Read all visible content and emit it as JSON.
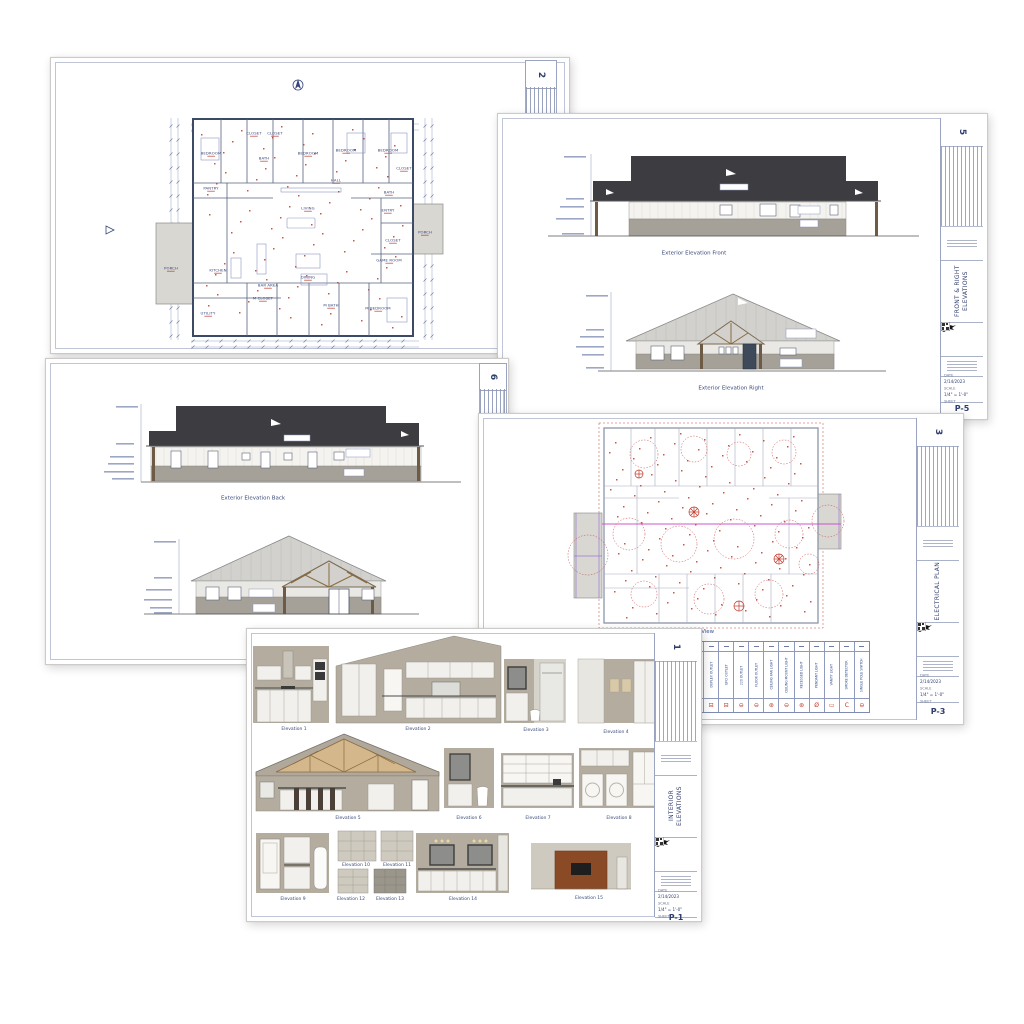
{
  "colors": {
    "line_navy": "#37477c",
    "line_red": "#c0392b",
    "roof_dark": "#3d3d41",
    "roof_light": "#d2d1cd",
    "stone_grey": "#a5a199",
    "siding_white": "#f4f3f0",
    "taupe_wall": "#b3ac9f",
    "taupe_light": "#cfcabf",
    "truss_wood": "#d4b88c",
    "accent_brown": "#8a4a26",
    "magenta": "#cc55cc"
  },
  "sheet_floor_plan": {
    "number": "2",
    "rooms": [
      {
        "label": "BEDROOM",
        "x": 160,
        "y": 96
      },
      {
        "label": "CLOSET",
        "x": 203,
        "y": 76
      },
      {
        "label": "CLOSET",
        "x": 224,
        "y": 76
      },
      {
        "label": "BATH",
        "x": 213,
        "y": 101
      },
      {
        "label": "BEDROOM",
        "x": 257,
        "y": 96
      },
      {
        "label": "BEDROOM",
        "x": 295,
        "y": 93
      },
      {
        "label": "BEDROOM",
        "x": 337,
        "y": 93
      },
      {
        "label": "CLOSET",
        "x": 353,
        "y": 111
      },
      {
        "label": "HALL",
        "x": 285,
        "y": 123
      },
      {
        "label": "PANTRY",
        "x": 160,
        "y": 131
      },
      {
        "label": "BATH",
        "x": 338,
        "y": 135
      },
      {
        "label": "ENTRY",
        "x": 337,
        "y": 153
      },
      {
        "label": "LIVING",
        "x": 257,
        "y": 151
      },
      {
        "label": "PORCH",
        "x": 374,
        "y": 175
      },
      {
        "label": "CLOSET",
        "x": 342,
        "y": 183
      },
      {
        "label": "GAME ROOM",
        "x": 338,
        "y": 203
      },
      {
        "label": "KITCHEN",
        "x": 167,
        "y": 213
      },
      {
        "label": "PORCH",
        "x": 120,
        "y": 211
      },
      {
        "label": "BAR AREA",
        "x": 217,
        "y": 228
      },
      {
        "label": "DINING",
        "x": 257,
        "y": 220
      },
      {
        "label": "UTILITY",
        "x": 157,
        "y": 256
      },
      {
        "label": "M CLOSET",
        "x": 212,
        "y": 241
      },
      {
        "label": "M BATH",
        "x": 280,
        "y": 248
      },
      {
        "label": "M BEDROOM",
        "x": 327,
        "y": 251
      }
    ]
  },
  "sheet_front_right": {
    "number": "5",
    "elevation_titles": [
      {
        "label": "Exterior Elevation Front",
        "x": 196,
        "y": 139
      },
      {
        "label": "Exterior Elevation Right",
        "x": 233,
        "y": 274
      }
    ],
    "titleblock": {
      "discipline": "FRONT & RIGHT ELEVATIONS",
      "date_label": "DATE",
      "date": "2/14/2023",
      "scale_label": "SCALE",
      "scale": "1/4\" = 1'-0\"",
      "sheet_label": "SHEET",
      "sheet_code": "P-5"
    }
  },
  "sheet_back_left": {
    "number": "6",
    "elevation_titles": [
      {
        "label": "Exterior Elevation Back",
        "x": 207,
        "y": 139
      }
    ]
  },
  "sheet_electrical": {
    "number": "3",
    "plan_view_label": "Plan View",
    "legend": [
      {
        "label": "ELECTRICAL PANEL",
        "symbol": "▮"
      },
      {
        "label": "DUPLEX OUTLET",
        "symbol": "⊟"
      },
      {
        "label": "GFCI OUTLET",
        "symbol": "⊟"
      },
      {
        "label": "220 OUTLET",
        "symbol": "⊖"
      },
      {
        "label": "FLOOR OUTLET",
        "symbol": "⊖"
      },
      {
        "label": "CEILING FAN LIGHT",
        "symbol": "⊛"
      },
      {
        "label": "CEILING MOUNT LIGHT",
        "symbol": "⊖"
      },
      {
        "label": "RECESSED LIGHT",
        "symbol": "⊛"
      },
      {
        "label": "PENDANT LIGHT",
        "symbol": "Ø"
      },
      {
        "label": "VANITY LIGHT",
        "symbol": "▭"
      },
      {
        "label": "SMOKE DETECTOR",
        "symbol": "C"
      },
      {
        "label": "SINGLE POLE SWITCH",
        "symbol": "⊖"
      }
    ],
    "titleblock": {
      "discipline": "ELECTRICAL PLAN",
      "date_label": "DATE",
      "date": "2/14/2023",
      "scale_label": "SCALE",
      "scale": "1/4\" = 1'-0\"",
      "sheet_label": "SHEET",
      "sheet_code": "P-3"
    }
  },
  "sheet_interior": {
    "number": "1",
    "elevation_labels": [
      {
        "label": "Elevation 1",
        "x": 47,
        "y": 100
      },
      {
        "label": "Elevation 2",
        "x": 171,
        "y": 100
      },
      {
        "label": "Elevation 3",
        "x": 289,
        "y": 101
      },
      {
        "label": "Elevation 4",
        "x": 369,
        "y": 103
      },
      {
        "label": "Elevation 5",
        "x": 101,
        "y": 189
      },
      {
        "label": "Elevation 6",
        "x": 222,
        "y": 189
      },
      {
        "label": "Elevation 7",
        "x": 291,
        "y": 189
      },
      {
        "label": "Elevation 8",
        "x": 372,
        "y": 189
      },
      {
        "label": "Elevation 9",
        "x": 46,
        "y": 270
      },
      {
        "label": "Elevation 10",
        "x": 109,
        "y": 236
      },
      {
        "label": "Elevation 11",
        "x": 150,
        "y": 236
      },
      {
        "label": "Elevation 12",
        "x": 104,
        "y": 270
      },
      {
        "label": "Elevation 13",
        "x": 143,
        "y": 270
      },
      {
        "label": "Elevation 14",
        "x": 216,
        "y": 270
      },
      {
        "label": "Elevation 15",
        "x": 342,
        "y": 269
      }
    ],
    "titleblock": {
      "discipline": "INTERIOR ELEVATIONS",
      "date_label": "DATE",
      "date": "2/14/2023",
      "scale_label": "SCALE",
      "scale": "1/4\" = 1'-0\"",
      "sheet_label": "SHEET",
      "sheet_code": "P-1"
    }
  }
}
